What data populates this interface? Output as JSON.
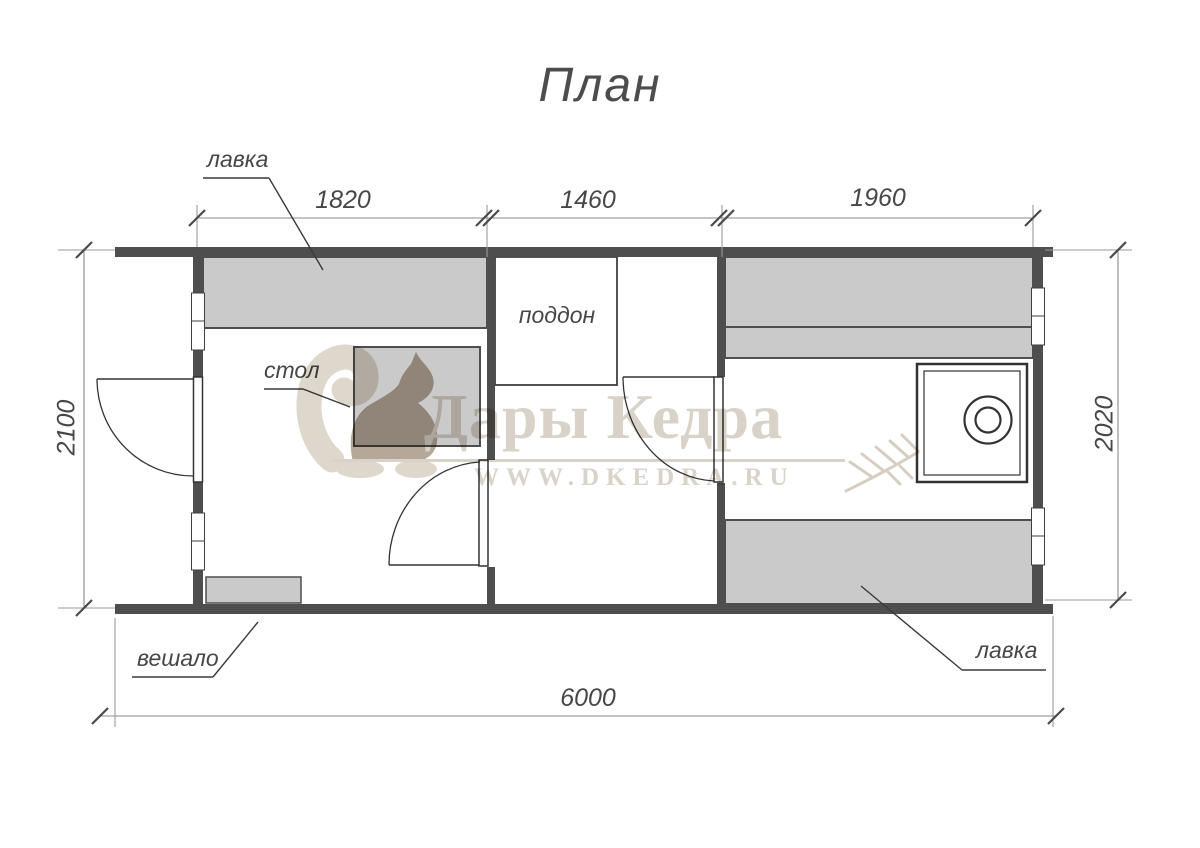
{
  "title": "План",
  "plan": {
    "labels": {
      "bench_top": "лавка",
      "table": "стол",
      "shower_tray": "поддон",
      "coat_rack": "вешало",
      "bench_bottom": "лавка"
    },
    "dimensions": {
      "top": [
        "1820",
        "1460",
        "1960"
      ],
      "left": "2100",
      "right": "2020",
      "bottom": "6000"
    },
    "rooms": [
      "тамбур/предбанник",
      "моечная",
      "парная"
    ]
  },
  "watermark": {
    "brand": "Дары Кедра",
    "website": "WWW.DKEDRA.RU"
  },
  "colors": {
    "wall": "#4e4e4e",
    "furniture_fill": "#cacaca",
    "outline": "#333333",
    "dim_line": "#8a8a8a",
    "text": "#474747",
    "watermark_light": "#d9d2c8",
    "watermark_dark": "#b6a898"
  }
}
